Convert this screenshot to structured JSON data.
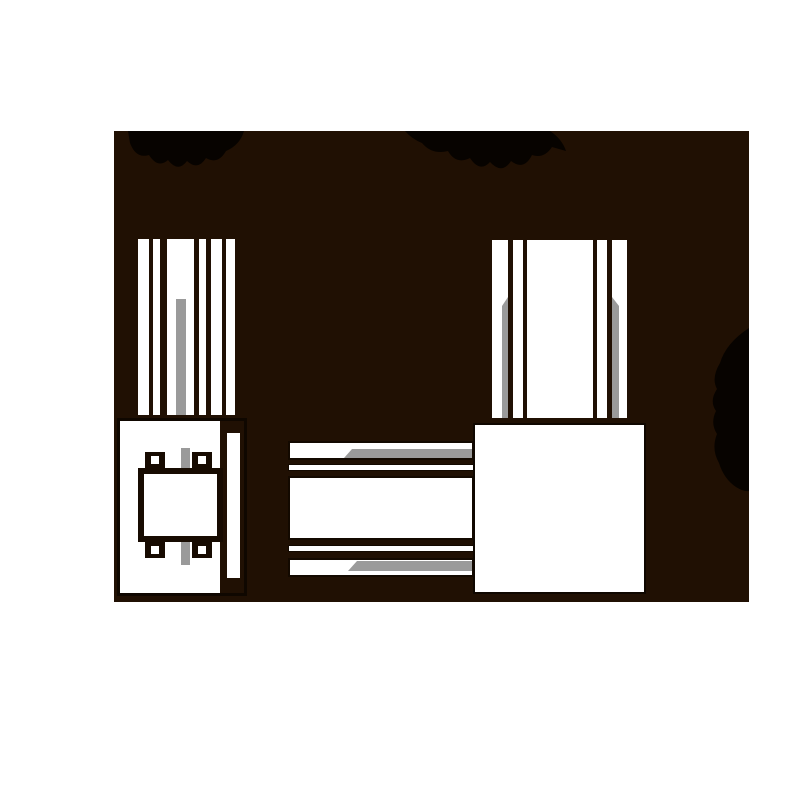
{
  "canvas": {
    "width": 800,
    "height": 800,
    "background": "#ffffff"
  },
  "silhouette_panel": {
    "x": 114,
    "y": 131,
    "width": 635,
    "height": 471,
    "color": "#201003"
  },
  "palette": {
    "page_background": "#ffffff",
    "panel_dark_brown": "#201003",
    "drawing_white": "#ffffff",
    "slot_gray": "#9a9a9a",
    "outline_dark": "#0f0700",
    "smudge_black": "#070300"
  },
  "views": {
    "left_side_view": {
      "fin_count": 6,
      "gray_slot_count": 1,
      "has_terminal_block": true,
      "terminal_bump_count": 4
    },
    "top_view": {
      "bar_count": 5,
      "gray_band_count": 2
    },
    "front_view": {
      "fin_count": 5,
      "gray_slot_count": 2,
      "has_body_box": true
    }
  },
  "smudges": [
    {
      "name": "top-left-illegible-label"
    },
    {
      "name": "top-right-illegible-label"
    },
    {
      "name": "right-edge-blot"
    }
  ]
}
